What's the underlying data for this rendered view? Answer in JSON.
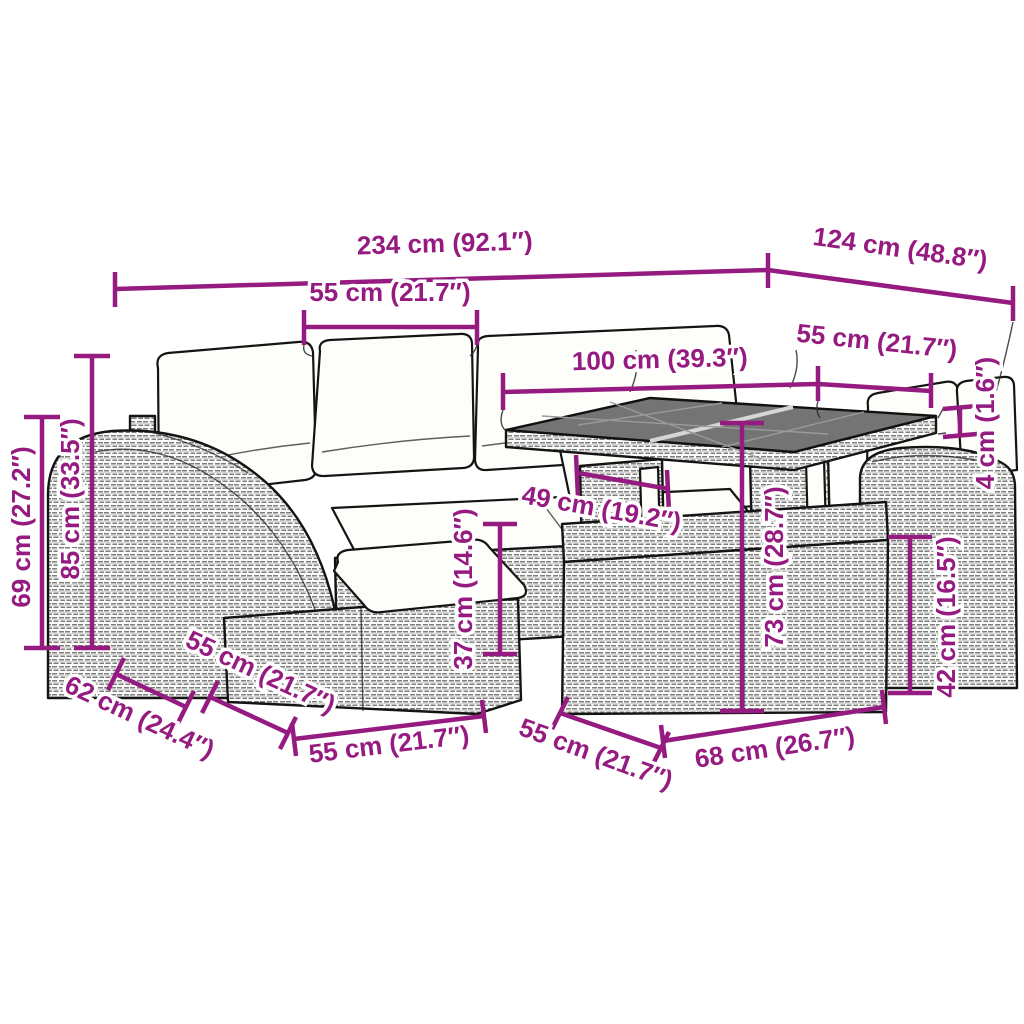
{
  "figure": {
    "kind": "product-dimension-diagram",
    "subject": "poly-rattan garden lounge set with corner sofa, footstool, storage box and glass-top table",
    "accent_color": "#951B81",
    "linework_color": "#141414",
    "cushion_color": "#fdfdfa",
    "glass_color": "#747474",
    "background_color": "#ffffff",
    "unit_format": "cm (inches)"
  },
  "dims": {
    "total_width": "234 cm (92.1″)",
    "total_depth": "124 cm (48.8″)",
    "seat_width": "55 cm (21.7″)",
    "table_length": "100 cm (39.3″)",
    "table_depth": "55 cm (21.7″)",
    "tabletop_thickness": "4 cm (1.6″)",
    "armrest_height": "69 cm (27.2″)",
    "backrest_height": "85 cm (33.5″)",
    "seat_height": "37 cm (14.6″)",
    "table_leg_span": "49 cm (19.2″)",
    "table_height": "73 cm (28.7″)",
    "storage_box_height": "42 cm (16.5″)",
    "armrest_depth": "62 cm (24.4″)",
    "seat_depth": "55 cm (21.7″)",
    "ottoman_width": "55 cm (21.7″)",
    "storage_box_depth": "55 cm (21.7″)",
    "storage_box_width": "68 cm (26.7″)"
  }
}
